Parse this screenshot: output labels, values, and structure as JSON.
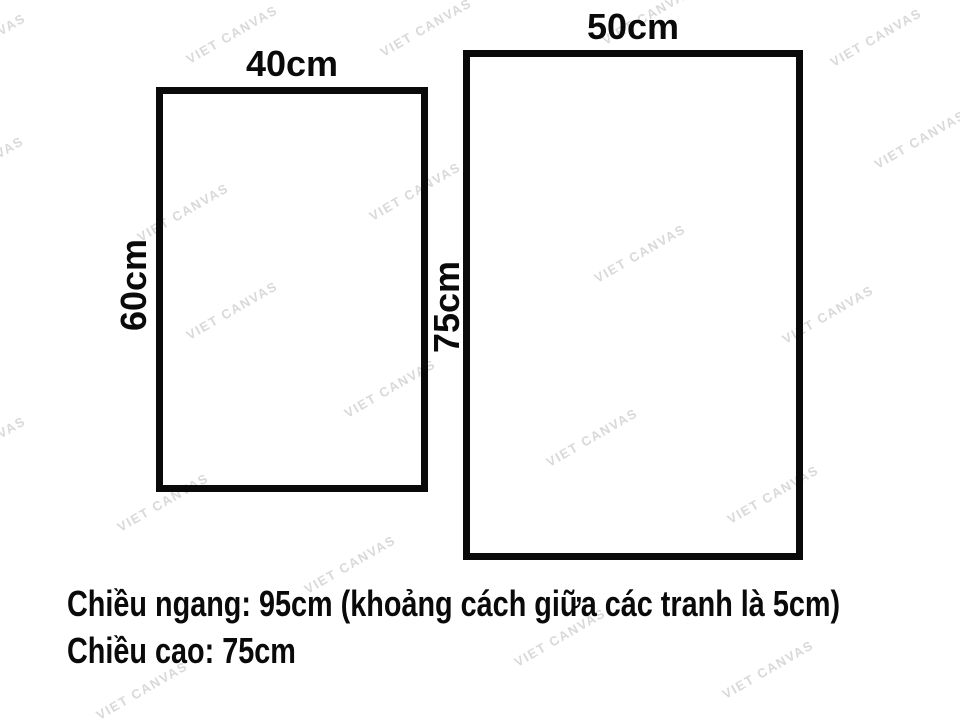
{
  "page": {
    "background_color": "#ffffff",
    "ink_color": "#0a0a0a"
  },
  "watermark": {
    "text": "VIET CANVAS",
    "color": "#d9d9d9",
    "rotation_deg": -30,
    "positions": [
      [
        -20,
        45
      ],
      [
        232,
        37
      ],
      [
        426,
        30
      ],
      [
        648,
        18
      ],
      [
        876,
        40
      ],
      [
        920,
        142
      ],
      [
        -22,
        168
      ],
      [
        183,
        215
      ],
      [
        415,
        194
      ],
      [
        640,
        256
      ],
      [
        828,
        317
      ],
      [
        232,
        313
      ],
      [
        390,
        391
      ],
      [
        592,
        440
      ],
      [
        -20,
        448
      ],
      [
        163,
        505
      ],
      [
        350,
        567
      ],
      [
        773,
        497
      ],
      [
        560,
        640
      ],
      [
        768,
        672
      ],
      [
        142,
        693
      ]
    ]
  },
  "frames": {
    "left": {
      "width_cm": 40,
      "height_cm": 60,
      "width_label": "40cm",
      "height_label": "60cm"
    },
    "right": {
      "width_cm": 50,
      "height_cm": 75,
      "width_label": "50cm",
      "height_label": "75cm"
    }
  },
  "caption": {
    "line1": "Chiều ngang: 95cm (khoảng cách giữa các tranh là 5cm)",
    "line2": "Chiều cao: 75cm"
  }
}
